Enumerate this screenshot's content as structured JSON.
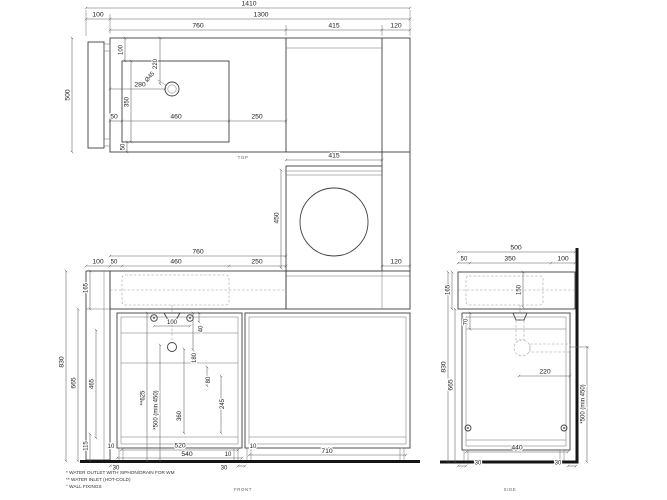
{
  "drawing": {
    "views": {
      "top": {
        "caption": "TOP",
        "overall_width": "1410",
        "left_panel": "100",
        "body_width": "1300",
        "counter_width": "760",
        "wm_width": "415",
        "side_panel": "120",
        "depth": "500",
        "sink_offset_top": "100",
        "drain_from_top": "220",
        "drain_diameter": "Ø45",
        "drain_from_left": "280",
        "sink_depth": "350",
        "sink_offset_left": "50",
        "sink_width": "460",
        "counter_right": "250",
        "sink_offset_bottom": "50"
      },
      "wm_elevation": {
        "width": "415",
        "height": "450"
      },
      "front": {
        "caption": "FRONT",
        "counter_width": "760",
        "left_panel": "100",
        "sink_offset_left": "50",
        "sink_width": "460",
        "counter_right": "250",
        "side_panel": "120",
        "counter_height": "165",
        "total_height": "830",
        "body_height": "665",
        "drawer_zone": "465",
        "plinth": "115",
        "inlet_spacing": "100",
        "dim_40": "40",
        "dim_180": "180",
        "dim_80": "80",
        "dim_245": "245",
        "dim_360": "360",
        "inlet_height": "**625",
        "outlet_height": "*500 (min 450)",
        "bottom_10_left": "10",
        "bottom_520": "520",
        "bottom_540": "540",
        "bottom_10_mid_upper": "10",
        "bottom_10_mid_lower": "10",
        "bottom_30_left": "30",
        "bottom_30_right": "30",
        "bay_width": "710"
      },
      "side": {
        "caption": "SIDE",
        "depth": "500",
        "front_50": "50",
        "mid_350": "350",
        "back_100": "100",
        "counter_height": "165",
        "basin_depth": "150",
        "rail_70": "70",
        "total_height": "830",
        "body_height": "665",
        "siphon_offset": "220",
        "outlet_height": "*500 (min 450)",
        "bottom_440": "440",
        "bottom_30_left": "30",
        "bottom_30_right": "30"
      }
    },
    "footnotes": [
      "* WATER OUTLET WITH SIPHON/DRAIN FOR WM",
      "** WATER INLET (HOT-COLD)",
      "° WALL FIXINGS"
    ],
    "colors": {
      "line": "#3f3f3f",
      "dimension": "#5c5c5c",
      "heavy": "#151515",
      "background": "#ffffff"
    }
  }
}
